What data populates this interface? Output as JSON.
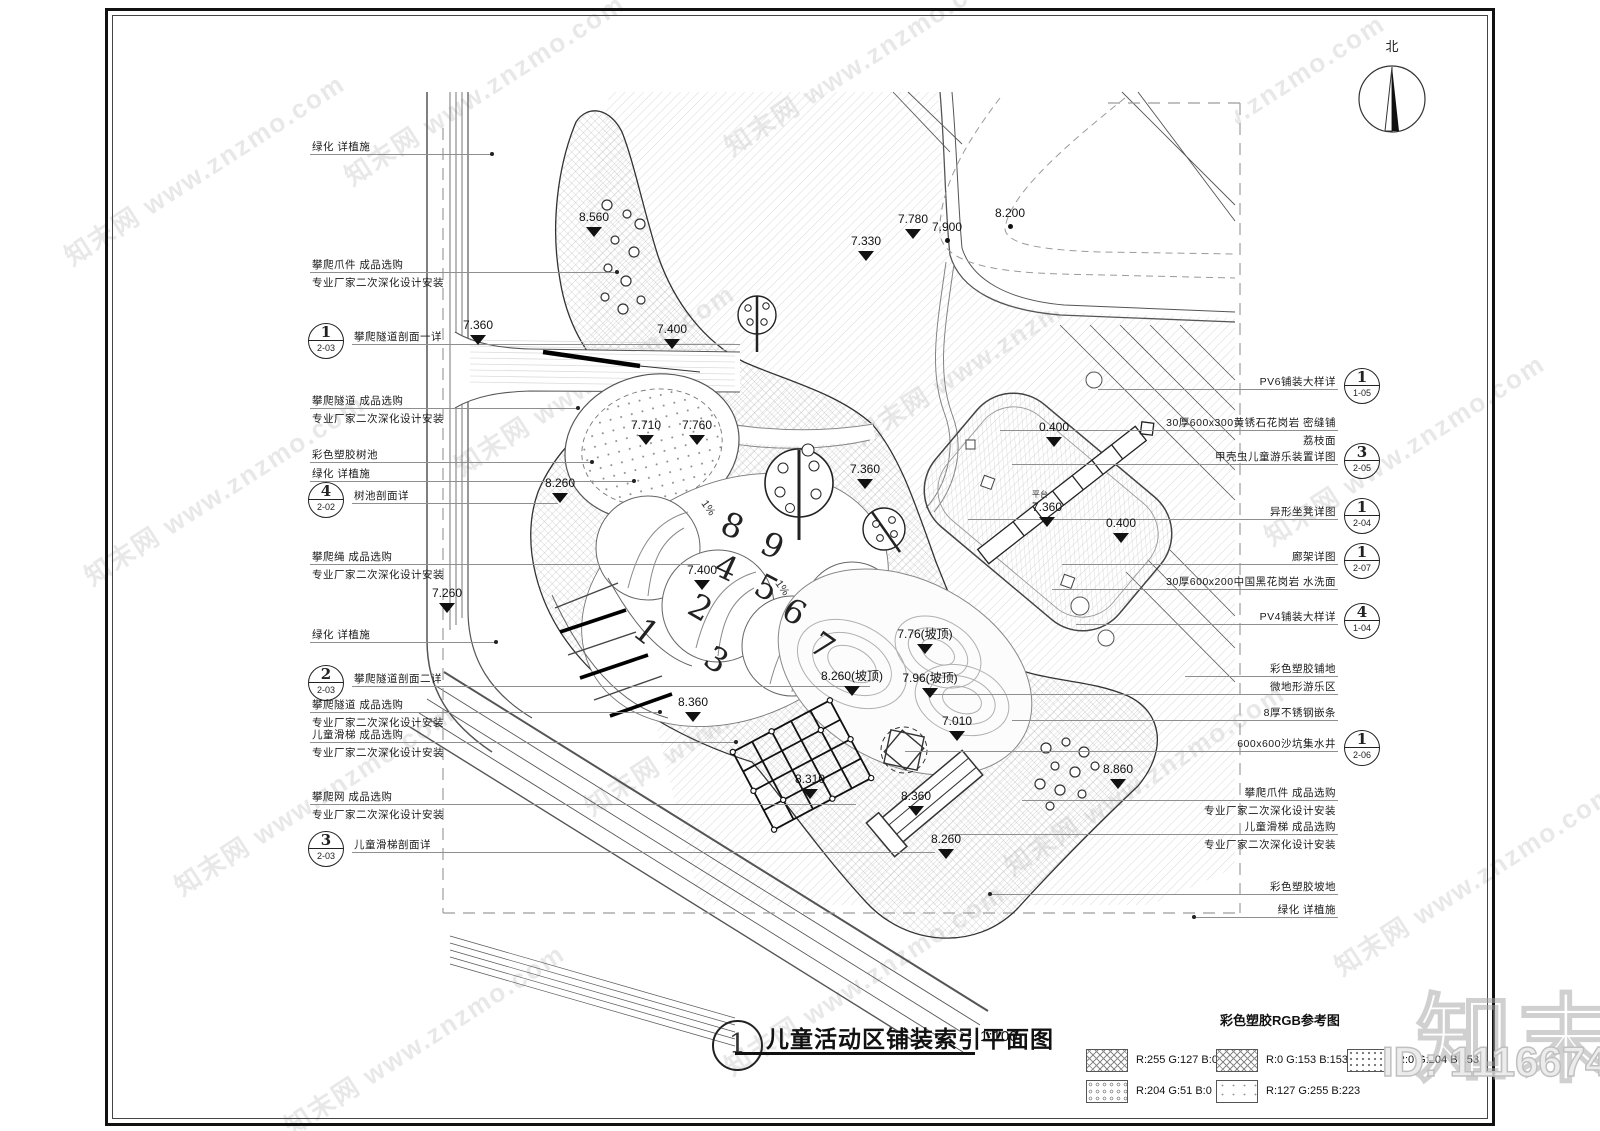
{
  "north": {
    "label": "北"
  },
  "title": {
    "ref_number": "1",
    "text": "儿童活动区铺装索引平面图",
    "scale": "1:100"
  },
  "legend": {
    "title": "彩色塑胶RGB参考图",
    "items": [
      {
        "pattern": "cross",
        "label": "R:255 G:127 B:0"
      },
      {
        "pattern": "cross",
        "label": "R:0 G:153 B:153"
      },
      {
        "pattern": "dots",
        "label": "R:0 G:204 B:153"
      },
      {
        "pattern": "honey",
        "label": "R:204 G:51 B:0"
      },
      {
        "pattern": "sparse",
        "label": "R:127 G:255 B:223"
      }
    ]
  },
  "watermark": {
    "text": "知末网 www.znzmo.com",
    "brand": "知末",
    "id_label": "ID: 1116674630"
  },
  "annotations": {
    "left": [
      {
        "y": 154,
        "text": "绿化 详植施",
        "line": [
          310,
          492
        ],
        "dot": 1
      },
      {
        "y": 272,
        "text": "攀爬爪件 成品选购",
        "text2": "专业厂家二次深化设计安装",
        "line": [
          310,
          617
        ],
        "dot": 1
      },
      {
        "y": 344,
        "text": "攀爬隧道剖面一详",
        "ref": {
          "n": "1",
          "s": "2-03"
        },
        "line": [
          352,
          740
        ]
      },
      {
        "y": 408,
        "text": "攀爬隧道 成品选购",
        "text2": "专业厂家二次深化设计安装",
        "line": [
          310,
          578
        ],
        "dot": 1
      },
      {
        "y": 462,
        "text": "彩色塑胶树池",
        "line": [
          310,
          592
        ],
        "dot": 1
      },
      {
        "y": 481,
        "text": "绿化 详植施",
        "line": [
          310,
          634
        ],
        "dot": 1
      },
      {
        "y": 503,
        "text": "树池剖面详",
        "ref": {
          "n": "4",
          "s": "2-02"
        },
        "line": [
          352,
          558
        ]
      },
      {
        "y": 564,
        "text": "攀爬绳 成品选购",
        "text2": "专业厂家二次深化设计安装",
        "line": [
          310,
          700
        ]
      },
      {
        "y": 642,
        "text": "绿化 详植施",
        "line": [
          310,
          496
        ],
        "dot": 1
      },
      {
        "y": 686,
        "text": "攀爬隧道剖面二详",
        "ref": {
          "n": "2",
          "s": "2-03"
        },
        "line": [
          352,
          870
        ]
      },
      {
        "y": 712,
        "text": "攀爬隧道 成品选购",
        "text2": "专业厂家二次深化设计安装",
        "line": [
          310,
          660
        ],
        "dot": 1
      },
      {
        "y": 742,
        "text": "儿童滑梯 成品选购",
        "text2": "专业厂家二次深化设计安装",
        "line": [
          310,
          736
        ],
        "dot": 1
      },
      {
        "y": 804,
        "text": "攀爬网 成品选购",
        "text2": "专业厂家二次深化设计安装",
        "line": [
          310,
          856
        ]
      },
      {
        "y": 852,
        "text": "儿童滑梯剖面详",
        "ref": {
          "n": "3",
          "s": "2-03"
        },
        "line": [
          352,
          935
        ]
      }
    ],
    "right": [
      {
        "y": 389,
        "text": "PV6铺装大样详",
        "ref": {
          "n": "1",
          "s": "1-05"
        },
        "line": [
          1098,
          1338
        ]
      },
      {
        "y": 430,
        "text": "30厚600x300黄锈石花岗岩 密缝铺",
        "text2": "荔枝面",
        "line": [
          1000,
          1338
        ]
      },
      {
        "y": 464,
        "text": "甲壳虫儿童游乐装置详图",
        "ref": {
          "n": "3",
          "s": "2-05"
        },
        "line": [
          1012,
          1338
        ]
      },
      {
        "y": 519,
        "text": "异形坐凳详图",
        "ref": {
          "n": "1",
          "s": "2-04"
        },
        "line": [
          968,
          1338
        ]
      },
      {
        "y": 564,
        "text": "廊架详图",
        "ref": {
          "n": "1",
          "s": "2-07"
        },
        "line": [
          1062,
          1338
        ]
      },
      {
        "y": 589,
        "text": "30厚600x200中国黑花岗岩 水洗面",
        "line": [
          1052,
          1338
        ]
      },
      {
        "y": 624,
        "text": "PV4铺装大样详",
        "ref": {
          "n": "4",
          "s": "1-04"
        },
        "line": [
          1076,
          1338
        ]
      },
      {
        "y": 676,
        "text": "彩色塑胶铺地",
        "line": [
          1185,
          1338
        ]
      },
      {
        "y": 694,
        "text": "微地形游乐区",
        "line": [
          930,
          1338
        ]
      },
      {
        "y": 720,
        "text": "8厚不锈钢嵌条",
        "line": [
          1012,
          1338
        ]
      },
      {
        "y": 751,
        "text": "600x600沙坑集水井",
        "ref": {
          "n": "1",
          "s": "2-06"
        },
        "line": [
          905,
          1338
        ]
      },
      {
        "y": 800,
        "text": "攀爬爪件 成品选购",
        "text2": "专业厂家二次深化设计安装",
        "line": [
          1022,
          1338
        ]
      },
      {
        "y": 834,
        "text": "儿童滑梯 成品选购",
        "text2": "专业厂家二次深化设计安装",
        "line": [
          952,
          1338
        ]
      },
      {
        "y": 894,
        "text": "彩色塑胶坡地",
        "line": [
          990,
          1338
        ],
        "dot": 1
      },
      {
        "y": 917,
        "text": "绿化 详植施",
        "line": [
          1194,
          1338
        ],
        "dot": 1
      }
    ]
  },
  "plan": {
    "elevation_markers": [
      {
        "x": 594,
        "y": 222,
        "v": "8.560"
      },
      {
        "x": 478,
        "y": 330,
        "v": "7.360"
      },
      {
        "x": 672,
        "y": 334,
        "v": "7.400"
      },
      {
        "x": 646,
        "y": 430,
        "v": "7.710"
      },
      {
        "x": 697,
        "y": 430,
        "v": "7.760"
      },
      {
        "x": 560,
        "y": 488,
        "v": "8.260"
      },
      {
        "x": 447,
        "y": 598,
        "v": "7.260"
      },
      {
        "x": 866,
        "y": 246,
        "v": "7.330"
      },
      {
        "x": 913,
        "y": 224,
        "v": "7.780"
      },
      {
        "x": 947,
        "y": 232,
        "v": "7.900",
        "t": "dot"
      },
      {
        "x": 1010,
        "y": 218,
        "v": "8.200",
        "t": "dot"
      },
      {
        "x": 865,
        "y": 474,
        "v": "7.360"
      },
      {
        "x": 702,
        "y": 575,
        "v": "7.400"
      },
      {
        "x": 1054,
        "y": 432,
        "v": "0.400"
      },
      {
        "x": 1047,
        "y": 512,
        "v": "7.360"
      },
      {
        "x": 1121,
        "y": 528,
        "v": "0.400"
      },
      {
        "x": 852,
        "y": 681,
        "v": "8.260(坡顶)"
      },
      {
        "x": 925,
        "y": 639,
        "v": "7.76(坡顶)"
      },
      {
        "x": 930,
        "y": 683,
        "v": "7.96(坡顶)"
      },
      {
        "x": 693,
        "y": 707,
        "v": "8.360"
      },
      {
        "x": 810,
        "y": 784,
        "v": "8.310"
      },
      {
        "x": 916,
        "y": 801,
        "v": "8.360"
      },
      {
        "x": 946,
        "y": 844,
        "v": "8.260"
      },
      {
        "x": 957,
        "y": 726,
        "v": "7.010"
      },
      {
        "x": 1118,
        "y": 774,
        "v": "8.860"
      }
    ],
    "play_numbers": [
      {
        "x": 636,
        "y": 612,
        "v": "1",
        "rot": 38
      },
      {
        "x": 690,
        "y": 588,
        "v": "2",
        "rot": 30
      },
      {
        "x": 706,
        "y": 640,
        "v": "3",
        "rot": 32
      },
      {
        "x": 716,
        "y": 548,
        "v": "4",
        "rot": 25
      },
      {
        "x": 756,
        "y": 568,
        "v": "5",
        "rot": 28
      },
      {
        "x": 784,
        "y": 592,
        "v": "6",
        "rot": 30
      },
      {
        "x": 812,
        "y": 626,
        "v": "7",
        "rot": 35
      },
      {
        "x": 722,
        "y": 506,
        "v": "8",
        "rot": 22
      },
      {
        "x": 762,
        "y": 526,
        "v": "9",
        "rot": 25
      }
    ],
    "slope_labels": [
      {
        "x": 700,
        "y": 502,
        "v": "1%",
        "rot": 55
      },
      {
        "x": 774,
        "y": 582,
        "v": "1%",
        "rot": 55
      }
    ],
    "area_label": "平台"
  }
}
